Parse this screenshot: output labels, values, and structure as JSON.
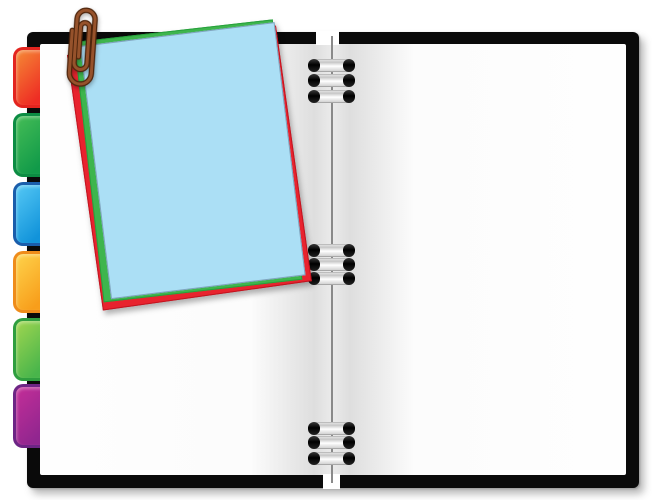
{
  "scene": {
    "background": "#ffffff",
    "cover": {
      "label": "black notebook cover",
      "color": "#0a0a0a"
    },
    "pages": {
      "left_label": "blank left page",
      "right_label": "blank right page",
      "color": "#fdfdfd",
      "gutter_shade": "#dedede"
    },
    "spine": {
      "label": "wire spine",
      "color": "#6f6f6f",
      "ring_groups": 3,
      "rings_per_group": 3,
      "ring_cap_color": "#111111",
      "ring_body_color": "#ececec"
    },
    "tabs": [
      {
        "label": "red-orange index tab",
        "css": "--b:#e3251f;--g1:#f58a35;--g2:#ee2c24"
      },
      {
        "label": "green index tab",
        "css": "--b:#0c8c43;--g1:#45bd56;--g2:#119a49"
      },
      {
        "label": "blue index tab",
        "css": "--b:#1a5dab;--g1:#55c8f5;--g2:#1193da"
      },
      {
        "label": "orange-yellow index tab",
        "css": "--b:#ef8c1a;--g1:#fed34b;--g2:#f89e1b"
      },
      {
        "label": "lime-green index tab",
        "css": "--b:#2f9e3f;--g1:#a0d650;--g2:#49b54b"
      },
      {
        "label": "purple index tab",
        "css": "--b:#6d2585;--g1:#c42e98;--g2:#90268f"
      }
    ],
    "notes": [
      {
        "label": "red paper note",
        "css": "--c:#e8232e;--e:#c21420"
      },
      {
        "label": "green paper note",
        "css": "--c:#3eb54d;--e:#27a03c"
      },
      {
        "label": "light-blue paper note",
        "css": "--c:#abdff5;--e:#7fa3bd"
      }
    ],
    "paperclip": {
      "label": "brown paperclip",
      "css": "--wire:#96522b;--outline:#4e250c",
      "wire_color": "#96522b",
      "outline_color": "#4e250c"
    }
  }
}
